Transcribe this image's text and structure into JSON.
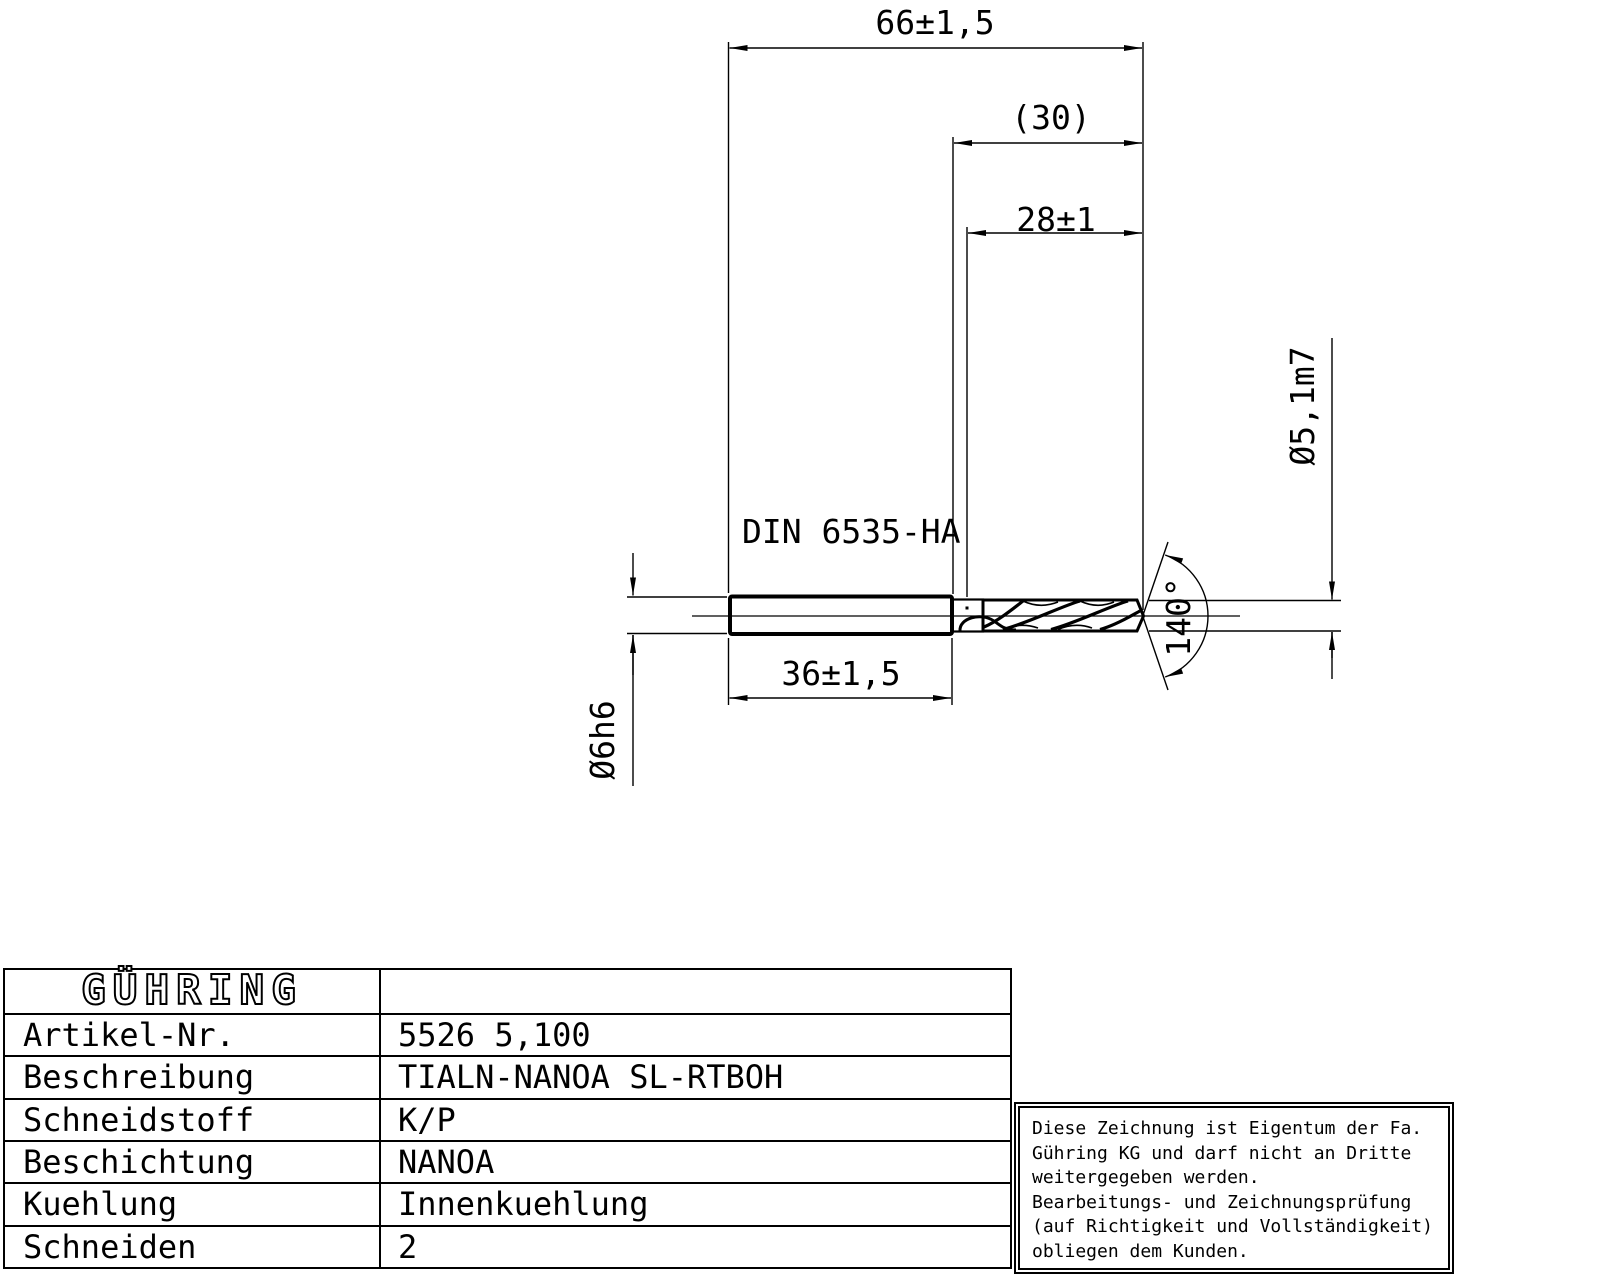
{
  "drawing": {
    "dim_total_length": "66±1,5",
    "dim_flute_overall": "(30)",
    "dim_flute_length": "28±1",
    "dim_shank_length": "36±1,5",
    "shank_standard": "DIN 6535-HA",
    "dim_shank_diameter": "Ø6h6",
    "dim_cutting_diameter": "Ø5,1m7",
    "dim_point_angle": "140°"
  },
  "table": {
    "brand": "GÜHRING",
    "rows": [
      {
        "label": "Artikel-Nr.",
        "value": "5526 5,100"
      },
      {
        "label": "Beschreibung",
        "value": "TIALN-NANOA SL-RTBOH"
      },
      {
        "label": "Schneidstoff",
        "value": "K/P"
      },
      {
        "label": "Beschichtung",
        "value": "NANOA"
      },
      {
        "label": "Kuehlung",
        "value": "Innenkuehlung"
      },
      {
        "label": "Schneiden",
        "value": "2"
      }
    ]
  },
  "note": {
    "lines": [
      "Diese Zeichnung ist Eigentum der Fa.",
      "Gühring KG und darf nicht an Dritte",
      "weitergegeben werden.",
      "Bearbeitungs- und Zeichnungsprüfung",
      "(auf Richtigkeit und Vollständigkeit)",
      "obliegen dem Kunden."
    ]
  },
  "colors": {
    "ink": "#000000",
    "paper": "#ffffff"
  }
}
